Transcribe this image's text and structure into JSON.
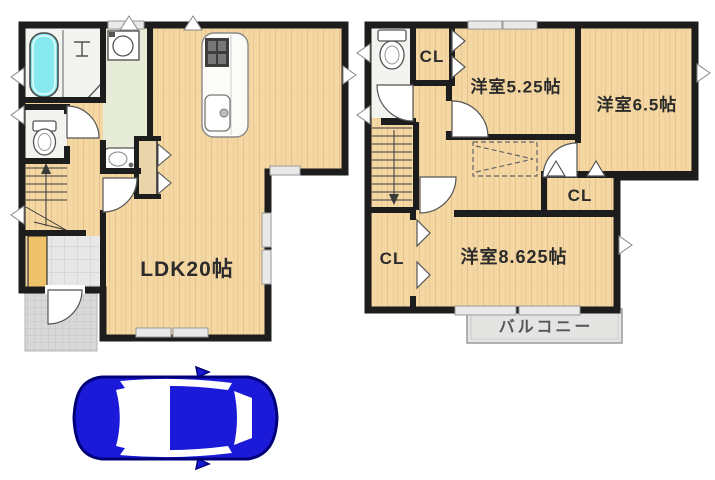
{
  "plan_title": "2-story house floor plan with parking",
  "labels": {
    "ldk": "LDK20帖",
    "room_525": "洋室5.25帖",
    "room_65": "洋室6.5帖",
    "room_8625": "洋室8.625帖",
    "cl": "CL",
    "balcony": "バルコニー"
  },
  "rooms": [
    {
      "floor": 1,
      "name": "LDK",
      "size_jo": "20帖"
    },
    {
      "floor": 2,
      "name": "洋室",
      "size_jo": "5.25帖"
    },
    {
      "floor": 2,
      "name": "洋室",
      "size_jo": "6.5帖"
    },
    {
      "floor": 2,
      "name": "洋室",
      "size_jo": "8.625帖"
    },
    {
      "floor": 2,
      "name": "CL",
      "count": 3
    },
    {
      "floor": 2,
      "name": "バルコニー"
    }
  ],
  "colors": {
    "wall": "#1d1d1d",
    "wood_floor": "#f4d7a3",
    "wood_grain": "#e2bd85",
    "wet_area_floor": "#f3f4f0",
    "washroom_floor": "#e7ecd9",
    "bathtub": "#86e9ee",
    "entrance_tile": "#e8e8e8",
    "porch_tile": "#d8d8d8",
    "balcony_fill": "#e4e4e2",
    "shoe_cabinet": "#f0c36a",
    "car_body": "#1a1ad8",
    "car_outline": "#000078"
  },
  "icons": [
    "bathtub-icon",
    "washing-machine-icon",
    "washbasin-icon",
    "toilet-icon",
    "stove-icon",
    "kitchen-sink-icon",
    "stairs-up-icon",
    "stairs-down-icon",
    "door-swing-icon",
    "window-icon",
    "car-icon"
  ]
}
